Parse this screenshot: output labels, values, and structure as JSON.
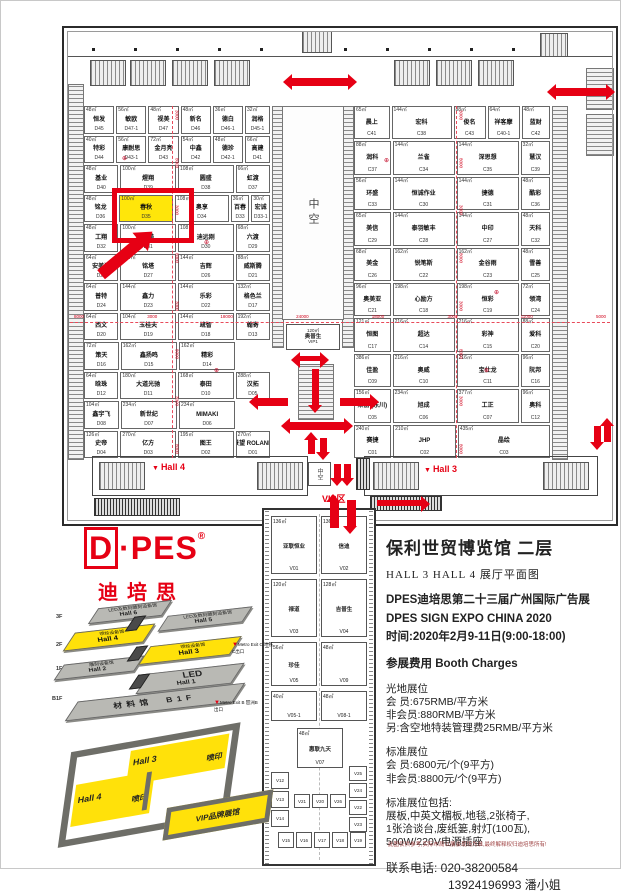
{
  "colors": {
    "accent_red": "#e60014",
    "highlight_yellow": "#ffe60a",
    "hall_yellow": "#ffe10a",
    "wall_gray": "#6e6e68"
  },
  "plan": {
    "hall4_label": "Hall 4",
    "hall3_label": "Hall 3",
    "atrium_label": "中空",
    "atrium_small_label": "中空",
    "vip_zone_label": "VIP区",
    "vip1": {
      "a": "120㎡",
      "n": "奥普生",
      "id": "VIP1"
    },
    "h_dims": [
      "8000",
      "3000",
      "18000",
      "24000",
      "18000",
      "3000",
      "11000",
      "5000"
    ],
    "v_dims": [
      "3000",
      "8000",
      "3000",
      "8000",
      "3000",
      "8000",
      "3000",
      "8000"
    ],
    "left_rows": [
      [
        {
          "a": "48㎡",
          "n": "恒发",
          "id": "D45"
        },
        {
          "a": "56㎡",
          "n": "敏欧",
          "id": "D47-1"
        },
        {
          "a": "48㎡",
          "n": "视美",
          "id": "D47"
        },
        {
          "a": "48㎡",
          "n": "新名",
          "id": "D46"
        },
        {
          "a": "36㎡",
          "n": "德白",
          "id": "D46-1"
        },
        {
          "a": "32㎡",
          "n": "润格",
          "id": "D45-1",
          "w": 0.8
        }
      ],
      [
        {
          "a": "40㎡",
          "n": "特彩",
          "id": "D44"
        },
        {
          "a": "56㎡",
          "n": "康耐思",
          "id": "D43-1"
        },
        {
          "a": "72㎡",
          "n": "金月亮",
          "id": "D43"
        },
        {
          "a": "54㎡",
          "n": "中鑫",
          "id": "D42"
        },
        {
          "a": "48㎡",
          "n": "德珍",
          "id": "D42-1"
        },
        {
          "a": "66㎡",
          "n": "高建",
          "id": "D41",
          "w": 0.8
        }
      ],
      [
        {
          "a": "48㎡",
          "n": "基业",
          "id": "D40"
        },
        {
          "a": "100㎡",
          "n": "煋翔",
          "id": "D39",
          "w": 1.7
        },
        {
          "a": "108㎡",
          "n": "圆盛",
          "id": "D38",
          "w": 1.7
        },
        {
          "a": "66㎡",
          "n": "虹渡",
          "id": "D37"
        }
      ],
      [
        {
          "a": "48㎡",
          "n": "铭龙",
          "id": "D36"
        },
        {
          "a": "100㎡",
          "n": "春秋",
          "id": "D35",
          "w": 1.7,
          "hl": true
        },
        {
          "a": "108㎡",
          "n": "奥享",
          "id": "D34",
          "w": 1.7
        },
        {
          "a": "36㎡",
          "n": "百春",
          "id": "D33",
          "w": 0.5
        },
        {
          "a": "30㎡",
          "n": "宏诚",
          "id": "D33-1",
          "w": 0.5
        }
      ],
      [
        {
          "a": "48㎡",
          "n": "工翔",
          "id": "D32"
        },
        {
          "a": "100㎡",
          "n": "拓美",
          "id": "D31",
          "w": 1.7
        },
        {
          "a": "108㎡",
          "n": "迪远刚",
          "id": "D30",
          "w": 1.7
        },
        {
          "a": "68㎡",
          "n": "六渡",
          "id": "D29"
        }
      ],
      [
        {
          "a": "64㎡",
          "n": "安美洁",
          "id": "D28"
        },
        {
          "a": "144㎡",
          "n": "铭塔",
          "id": "D27",
          "w": 1.7
        },
        {
          "a": "144㎡",
          "n": "吉辉",
          "id": "D26",
          "w": 1.7
        },
        {
          "a": "88㎡",
          "n": "威斯腾",
          "id": "D21"
        }
      ],
      [
        {
          "a": "64㎡",
          "n": "普特",
          "id": "D24"
        },
        {
          "a": "144㎡",
          "n": "鑫力",
          "id": "D23",
          "w": 1.7
        },
        {
          "a": "144㎡",
          "n": "乐彩",
          "id": "D22",
          "w": 1.7
        },
        {
          "a": "132㎡",
          "n": "格色兰",
          "id": "D17"
        }
      ],
      [
        {
          "a": "64㎡",
          "n": "西文",
          "id": "D20"
        },
        {
          "a": "104㎡",
          "n": "玉桂夫",
          "id": "D19",
          "w": 1.7
        },
        {
          "a": "144㎡",
          "n": "疏智",
          "id": "D18",
          "w": 1.7
        },
        {
          "a": "192㎡",
          "n": "翰寄",
          "id": "D13"
        }
      ],
      [
        {
          "a": "72㎡",
          "n": "策天",
          "id": "D16"
        },
        {
          "a": "162㎡",
          "n": "鑫扬鸣",
          "id": "D15",
          "w": 1.7
        },
        {
          "a": "162㎡",
          "n": "精彩",
          "id": "D14",
          "w": 1.7
        },
        {
          "sp": true
        }
      ],
      [
        {
          "a": "64㎡",
          "n": "晗珠",
          "id": "D12"
        },
        {
          "a": "180㎡",
          "n": "大道光驰",
          "id": "D11",
          "w": 1.7
        },
        {
          "a": "168㎡",
          "n": "泰田",
          "id": "D10",
          "w": 1.7
        },
        {
          "a": "288㎡",
          "n": "汉拓",
          "id": "D05"
        }
      ],
      [
        {
          "a": "104㎡",
          "n": "鑫宇飞",
          "id": "D08"
        },
        {
          "a": "234㎡",
          "n": "新世纪",
          "id": "D07",
          "w": 1.7
        },
        {
          "a": "234㎡",
          "n": "MIMAKI",
          "id": "D06",
          "w": 1.7
        },
        {
          "sp": true
        }
      ],
      [
        {
          "a": "126㎡",
          "n": "史帝",
          "id": "D04"
        },
        {
          "a": "270㎡",
          "n": "亿方",
          "id": "D03",
          "w": 1.7
        },
        {
          "a": "195㎡",
          "n": "图王",
          "id": "D02",
          "w": 1.7
        },
        {
          "a": "270㎡",
          "n": "景望 ROLAND",
          "id": "D01"
        }
      ]
    ],
    "right_rows": [
      [
        {
          "a": "65㎡",
          "n": "晨上",
          "id": "C41",
          "w": 0.9
        },
        {
          "a": "144㎡",
          "n": "宏科",
          "id": "C38",
          "w": 1.6
        },
        {
          "a": "88㎡",
          "n": "俊名",
          "id": "C43",
          "w": 0.8
        },
        {
          "a": "64㎡",
          "n": "祥客摩",
          "id": "C40-1",
          "w": 0.8
        },
        {
          "a": "48㎡",
          "n": "蓝财",
          "id": "C42",
          "w": 0.7
        }
      ],
      [
        {
          "a": "88㎡",
          "n": "润科",
          "id": "C37",
          "w": 0.9
        },
        {
          "a": "144㎡",
          "n": "兰雀",
          "id": "C34",
          "w": 1.6
        },
        {
          "a": "144㎡",
          "n": "深思想",
          "id": "C35",
          "w": 1.6
        },
        {
          "a": "32㎡",
          "n": "慧汉",
          "id": "C39",
          "w": 0.7
        }
      ],
      [
        {
          "a": "56㎡",
          "n": "环盛",
          "id": "C33",
          "w": 0.9
        },
        {
          "a": "144㎡",
          "n": "恒诚作业",
          "id": "C30",
          "w": 1.6
        },
        {
          "a": "144㎡",
          "n": "捷德",
          "id": "C31",
          "w": 1.6
        },
        {
          "a": "48㎡",
          "n": "酷彩",
          "id": "C36",
          "w": 0.7
        }
      ],
      [
        {
          "a": "65㎡",
          "n": "美信",
          "id": "C29",
          "w": 0.9
        },
        {
          "a": "144㎡",
          "n": "泰羽敏丰",
          "id": "C28",
          "w": 1.6
        },
        {
          "a": "144㎡",
          "n": "中印",
          "id": "C27",
          "w": 1.6
        },
        {
          "a": "48㎡",
          "n": "天科",
          "id": "C32",
          "w": 0.7
        }
      ],
      [
        {
          "a": "68㎡",
          "n": "美金",
          "id": "C26",
          "w": 0.9
        },
        {
          "a": "162㎡",
          "n": "锐笔斯",
          "id": "C22",
          "w": 1.6
        },
        {
          "a": "162㎡",
          "n": "金谷雨",
          "id": "C23",
          "w": 1.6
        },
        {
          "a": "48㎡",
          "n": "雪善",
          "id": "C25",
          "w": 0.7
        }
      ],
      [
        {
          "a": "96㎡",
          "n": "奥美亚",
          "id": "C21",
          "w": 0.9
        },
        {
          "a": "198㎡",
          "n": "心励方",
          "id": "C18",
          "w": 1.6
        },
        {
          "a": "198㎡",
          "n": "恒彩",
          "id": "C19",
          "w": 1.6
        },
        {
          "a": "72㎡",
          "n": "领湾",
          "id": "C24",
          "w": 0.7
        }
      ],
      [
        {
          "a": "121㎡",
          "n": "恒图",
          "id": "C17",
          "w": 0.9
        },
        {
          "a": "216㎡",
          "n": "超达",
          "id": "C14",
          "w": 1.6
        },
        {
          "a": "216㎡",
          "n": "彩神",
          "id": "C15",
          "w": 1.6
        },
        {
          "a": "88㎡",
          "n": "爱科",
          "id": "C20",
          "w": 0.7
        }
      ],
      [
        {
          "a": "386㎡",
          "n": "佳盈",
          "id": "C09",
          "w": 0.9
        },
        {
          "a": "216㎡",
          "n": "奥威",
          "id": "C10",
          "w": 1.6
        },
        {
          "a": "216㎡",
          "n": "宝仕龙",
          "id": "C11",
          "w": 1.6
        },
        {
          "a": "96㎡",
          "n": "阮邦",
          "id": "C16",
          "w": 0.7
        }
      ],
      [
        {
          "a": "156㎡",
          "n": "莱丽 (东川)",
          "id": "C05",
          "w": 0.9
        },
        {
          "a": "234㎡",
          "n": "旭成",
          "id": "C06",
          "w": 1.6
        },
        {
          "a": "377㎡",
          "n": "工正",
          "id": "C07",
          "w": 1.6
        },
        {
          "a": "96㎡",
          "n": "奥科",
          "id": "C12",
          "w": 0.7
        }
      ],
      [
        {
          "a": "240㎡",
          "n": "赛捷",
          "id": "C01",
          "w": 0.9
        },
        {
          "a": "210㎡",
          "n": "JHP",
          "id": "C02",
          "w": 1.6
        },
        {
          "a": "435㎡",
          "n": "晶绘",
          "id": "C03",
          "w": 2.4
        }
      ]
    ]
  },
  "vip": {
    "label": "VIP区",
    "pairs": [
      [
        {
          "a": "136㎡",
          "n": "亚联恒业",
          "id": "V01"
        },
        {
          "a": "136㎡",
          "n": "信迪",
          "id": "V02"
        }
      ],
      [
        {
          "a": "120㎡",
          "n": "禄道",
          "id": "V03"
        },
        {
          "a": "128㎡",
          "n": "吉普生",
          "id": "V04"
        }
      ],
      [
        {
          "a": "56㎡",
          "n": "珍佳",
          "id": "V05"
        },
        {
          "a": "48㎡",
          "n": "",
          "id": "V09"
        }
      ],
      [
        {
          "a": "40㎡",
          "n": "",
          "id": "V05-1"
        },
        {
          "a": "48㎡",
          "n": "",
          "id": "V08-1"
        }
      ]
    ],
    "center": {
      "a": "48㎡",
      "n": "惠联九天",
      "id": "V07"
    },
    "left_cells": [
      "V12",
      "V13",
      "V14"
    ],
    "mid_cells": [
      "V21",
      "V20",
      "V26"
    ],
    "right_cells": [
      "V25",
      "V24",
      "V22",
      "V23"
    ],
    "bottom_cells": [
      "V15",
      "V16",
      "V17",
      "V18",
      "V19"
    ]
  },
  "logo": {
    "wordmark_d": "D",
    "wordmark_rest": "·PES",
    "reg": "®",
    "cn": "迪培思"
  },
  "stack": {
    "floors": [
      "3F",
      "2F",
      "1F",
      "B1F"
    ],
    "halls": [
      {
        "label": "LED及数码雕刻设备馆",
        "name": "Hall 6"
      },
      {
        "label": "LED及数码雕刻设备馆",
        "name": "Hall 5"
      },
      {
        "label": "喷绘设备馆",
        "name": "Hall 4"
      },
      {
        "label": "喷绘设备馆",
        "name": "Hall 3"
      },
      {
        "label": "雕刻设备馆",
        "name": "Hall 2"
      },
      {
        "label": "LED",
        "name": "Hall 1"
      },
      {
        "label": "材料馆",
        "name": "B1F"
      }
    ],
    "metro_c": "Metro Exit C 地铁C出口",
    "metro_b": "Metro Exit B 琶洲B出口"
  },
  "minimap": {
    "hall3": "Hall 3",
    "hall4": "Hall 4",
    "pen3": "喷印",
    "pen4": "喷印",
    "vip": "VIP品牌展馆"
  },
  "info": {
    "venue": "保利世贸博览馆  二层",
    "subtitle": "HALL 3  HALL 4   展厅平面图",
    "expo_cn": "DPES迪培思第二十三届广州国际广告展",
    "expo_en": "DPES SIGN EXPO CHINA 2020",
    "time": "时间:2020年2月9-11日(9:00-18:00)",
    "charges_title": "参展费用  Booth Charges",
    "raw_title": "光地展位",
    "raw_lines": [
      "会  员:675RMB/平方米",
      "非会员:880RMB/平方米",
      "另:含空地特装管理费25RMB/平方米"
    ],
    "std_title": "标准展位",
    "std_lines": [
      "会  员:6800元/个(9平方)",
      "非会员:8800元/个(9平方)"
    ],
    "incl_title": "标准展位包括:",
    "incl_lines": [
      "展板,中英文楣板,地毯,2张椅子,",
      "1张洽谈台,废纸篓,射灯(100瓦),",
      "500W/220V电源插座"
    ],
    "tel": "联系电话: 020-38200584",
    "tel2": "13924196993 潘小姐"
  },
  "footnote": "此图仅供参考,实际布局以展会现场为准,最终解释权归迪培思所有!"
}
